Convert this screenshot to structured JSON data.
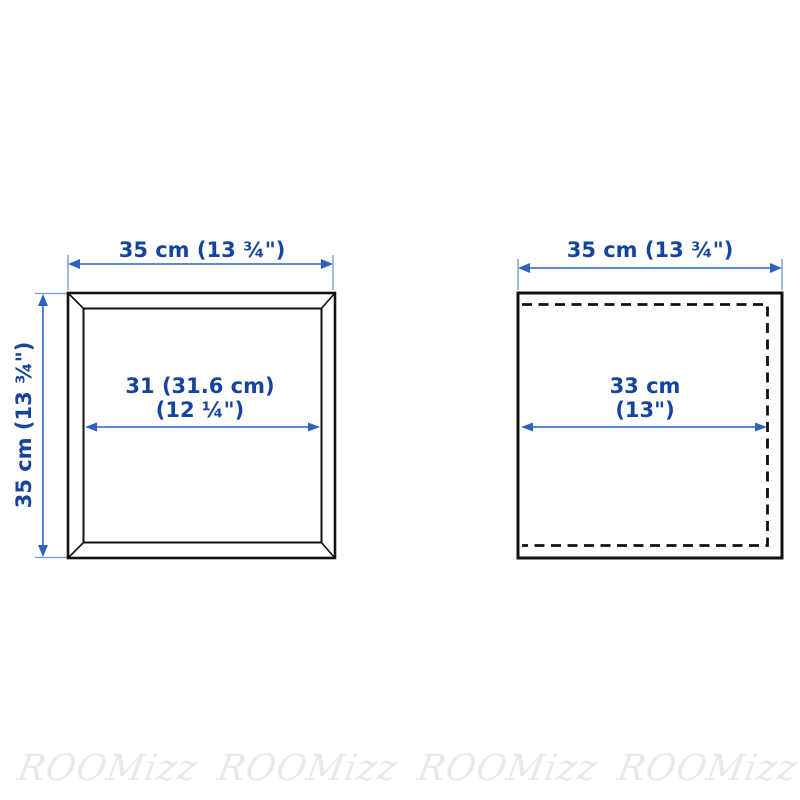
{
  "colors": {
    "dimension_text_blue": "#16449c",
    "arrow_blue": "#2f62c0",
    "outline_black": "#111111",
    "watermark_gray": "#e9e9e9",
    "background": "#ffffff"
  },
  "left_diagram": {
    "top_width_label": "35 cm (13 ¾\")",
    "side_height_label": "35 cm (13 ¾\")",
    "inner_width_label_line1": "31 (31.6 cm)",
    "inner_width_label_line2": "(12 ¼\")"
  },
  "right_diagram": {
    "top_width_label": "35 cm (13 ¾\")",
    "inner_width_label_line1": "33 cm",
    "inner_width_label_line2": "(13\")"
  },
  "watermarks": [
    "ROOMizz",
    "ROOMizz",
    "ROOMizz",
    "ROOMizz"
  ]
}
